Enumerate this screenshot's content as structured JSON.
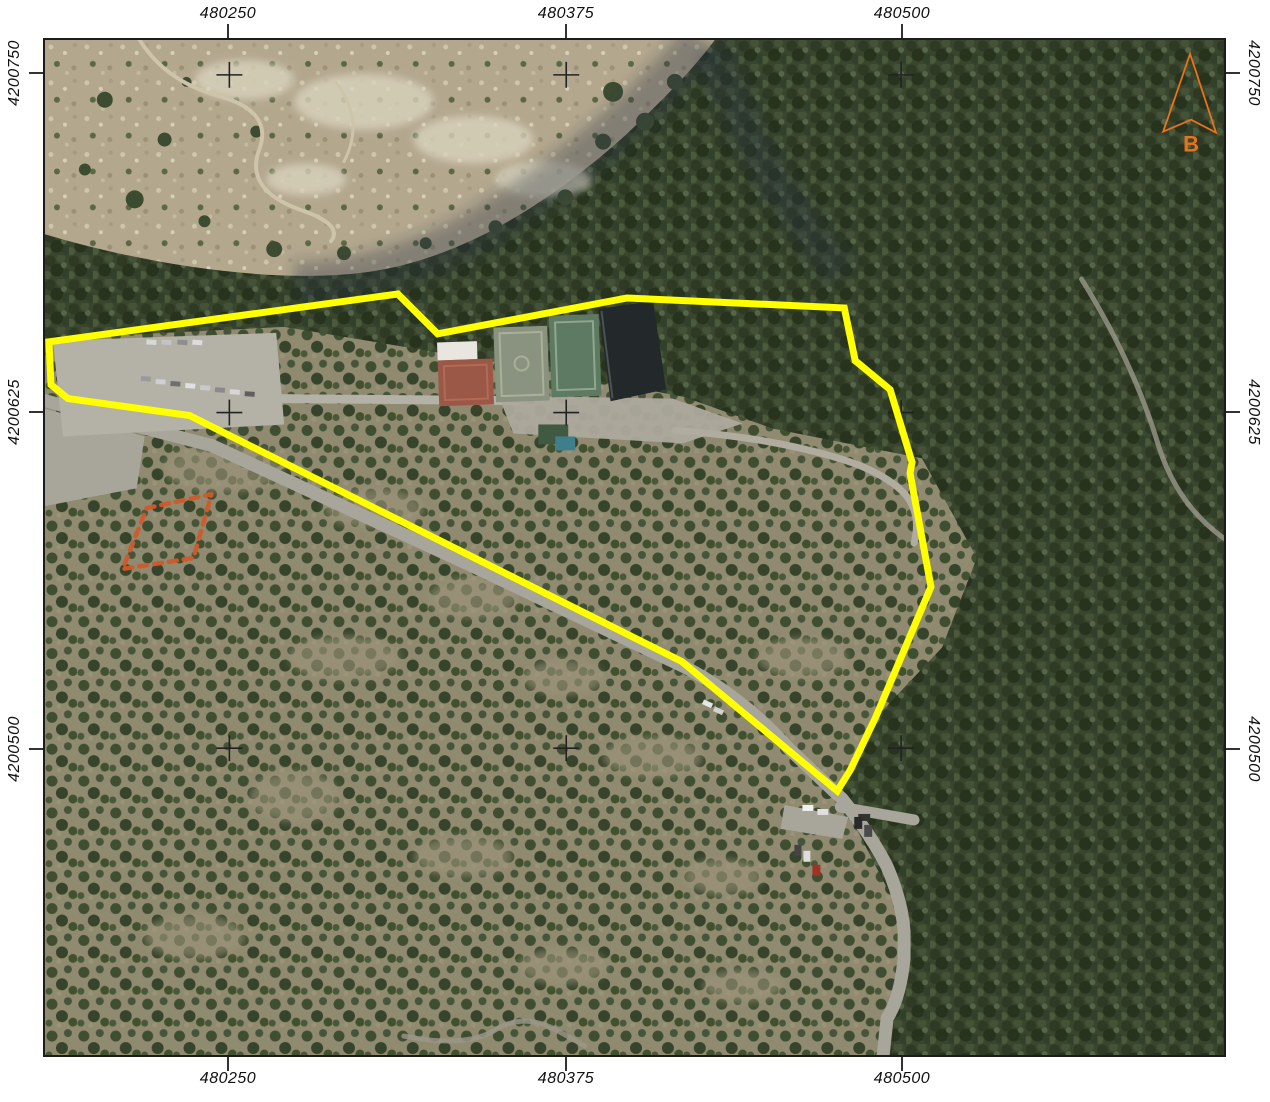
{
  "map": {
    "type": "aerial-orthophoto-with-grid",
    "grid": {
      "eastings": [
        "480250",
        "480375",
        "480500"
      ],
      "northings": [
        "4200750",
        "4200625",
        "4200500"
      ]
    },
    "north_arrow": {
      "label": "B",
      "color": "#e8731a"
    },
    "overlays": {
      "boundary_color": "#ffff00",
      "annotation_color": "#d05a2a",
      "grid_cross_color": "#222222",
      "frame_color": "#1c1c1c"
    }
  }
}
